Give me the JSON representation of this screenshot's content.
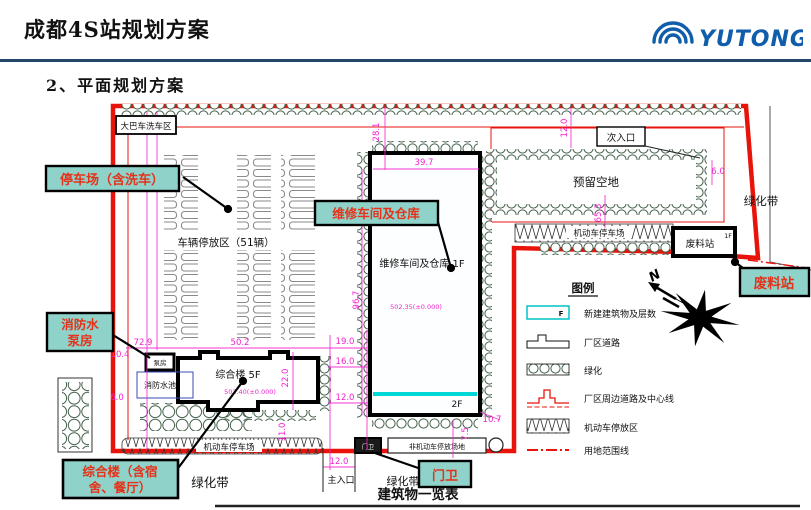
{
  "header": {
    "title": "成都4S站规划方案",
    "logo": "YUTONG",
    "brand_color": "#0f5dab"
  },
  "subtitle": "2、平面规划方案",
  "callouts": {
    "parking": "停车场（含洗车）",
    "workshop": "维修车间及仓库",
    "fire_pump_l1": "消防水",
    "fire_pump_l2": "泵房",
    "complex_l1": "综合楼（含宿",
    "complex_l2": "舍、餐厅）",
    "waste": "废料站",
    "gate": "门卫"
  },
  "labels": {
    "bus_wash": "大巴车洗车区",
    "vehicle_parking": "车辆停放区（51辆）",
    "workshop_text": "维修车间及仓库 1F",
    "workshop_2f": "2F",
    "workshop_elev": "502.35(±0.000)",
    "complex_text": "综合楼 5F",
    "complex_elev": "502.40(±0.000)",
    "fire_pool": "消防水池",
    "pump_house": "泵房",
    "reserved": "预留空地",
    "secondary_entrance": "次入口",
    "green_belt_right": "绿化带",
    "green_belt_bottom": "绿化带",
    "green_belt_gate": "绿化带",
    "motor_parking_top": "机动车停车场",
    "motor_parking_bottom": "机动车停车场",
    "non_motor": "非机动车停放场地",
    "waste_station": "废料站",
    "waste_1f": "1F",
    "gate_house": "门卫",
    "main_entrance": "主入口",
    "north": "N",
    "table_title": "建筑物一览表"
  },
  "dims": {
    "top_offset": "28.1",
    "workshop_width": "39.7",
    "workshop_height": "96.7",
    "reserved_offset": "12.0",
    "reserved_right": "6.0",
    "reserved_below": "65.3",
    "complex_top": "72.9",
    "left_upper": "10.4",
    "left_lower": "6.0",
    "complex_width": "50.2",
    "complex_height": "22.0",
    "gap_19": "19.0",
    "gap_16": "16.0",
    "gap_12": "12.0",
    "below_11": "11.0",
    "corner_10_7": "10.7",
    "corner_7_5": "7.5",
    "entrance_width": "12.0"
  },
  "legend": {
    "title": "图例",
    "f": "F",
    "items": [
      "新建建筑物及层数",
      "厂区道路",
      "绿化",
      "厂区周边道路及中心线",
      "机动车停放区",
      "用地范围线"
    ]
  }
}
